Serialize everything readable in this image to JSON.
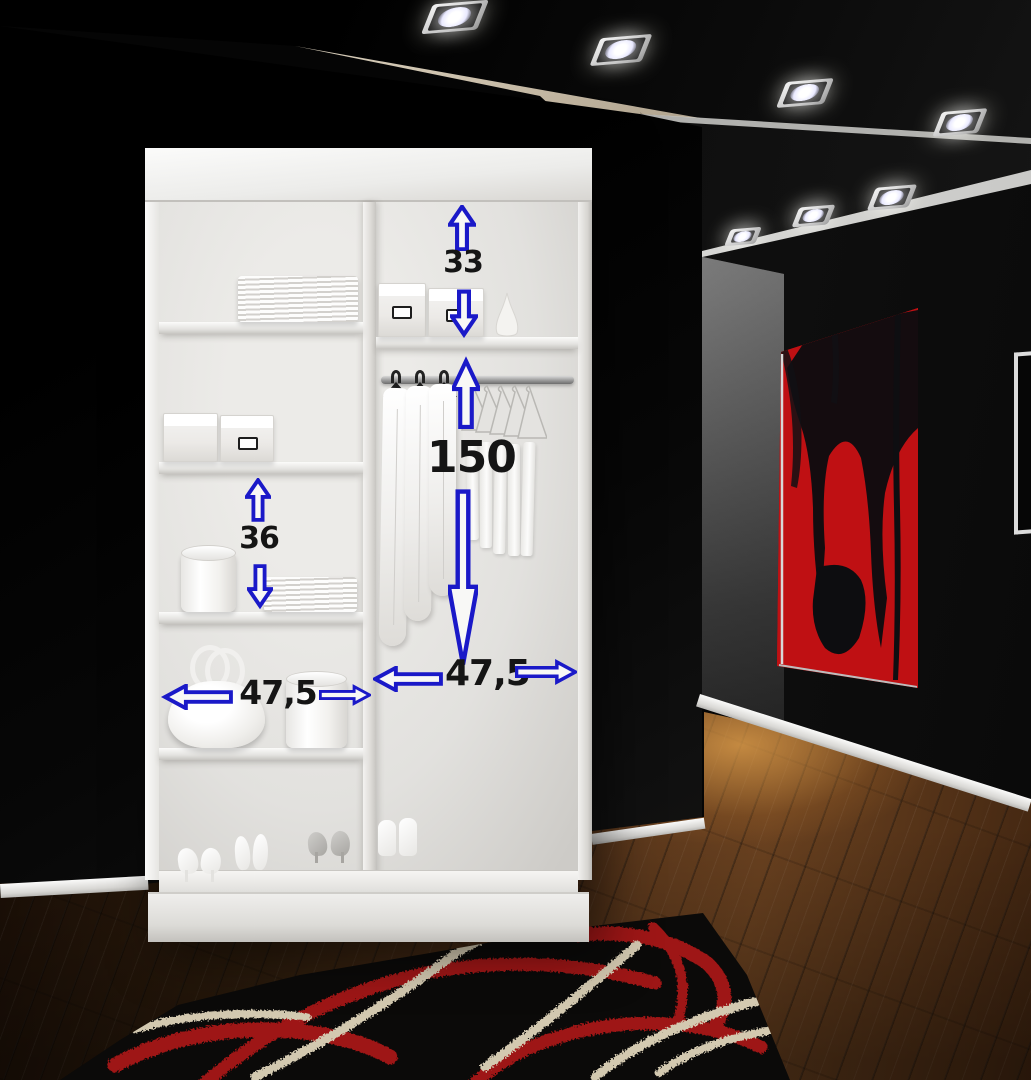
{
  "dimensions": {
    "top_section": "33",
    "hanging_section": "150",
    "shelf_section": "36",
    "left_column_width": "47,5",
    "right_column_width": "47,5"
  },
  "colors": {
    "annotation_arrow": "#1a19c8",
    "annotation_text": "#151515",
    "wardrobe_white": "#f2f1ef",
    "wall_black": "#0b0b0b",
    "ceiling_recess_cream": "#cfc4b0",
    "painting_red": "#bf1013",
    "floor_wood_brown": "#5d3718",
    "rug_black": "#0b0a09",
    "rug_red": "#9e1313",
    "rug_cream": "#d3c9b0"
  }
}
